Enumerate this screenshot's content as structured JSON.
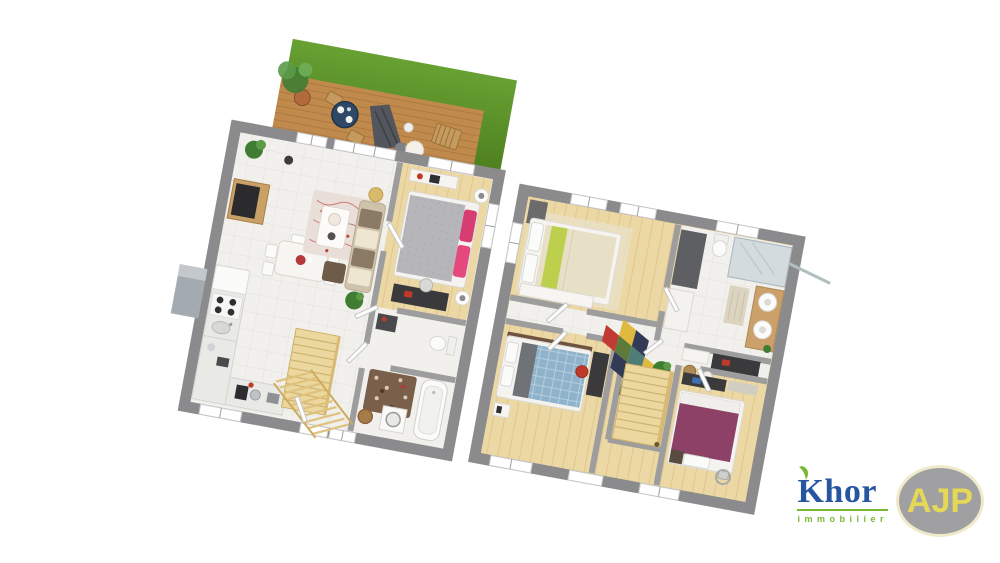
{
  "logo": {
    "brand": "Khor",
    "subtitle": "immobilier",
    "badge": "AJP"
  },
  "palette": {
    "grassLight": "#68a133",
    "grassDark": "#4d7f1e",
    "deck": "#c08a4c",
    "deckLine": "#9c6c34",
    "wall": "#8b8b8d",
    "partition": "#9d9d9e",
    "tile": "#f1f0ed",
    "tileLine": "#e3e1dc",
    "wood": "#ecd8a4",
    "woodLine": "#dcc084",
    "stair": "#ecd79f",
    "stairLine": "#cdb271",
    "bedGray": "#b6b6ba",
    "pink": "#d63d72",
    "lime": "#bcd04e",
    "cream": "#e8dfc7",
    "blueBed": "#8fb3cb",
    "purpleBed": "#8d4166",
    "darkFurn": "#3a3a3c",
    "sofa": "#cfc3ac",
    "sofaDark": "#8a7a66",
    "rugBrown": "#7a5f4a",
    "plant": "#3f7d33",
    "logoBlue": "#1b4e9b",
    "logoGreen": "#72b629",
    "badgeYellow": "#e3d64d",
    "badgeGray": "#9b9b9f",
    "badgeRing": "#efe9c8"
  }
}
